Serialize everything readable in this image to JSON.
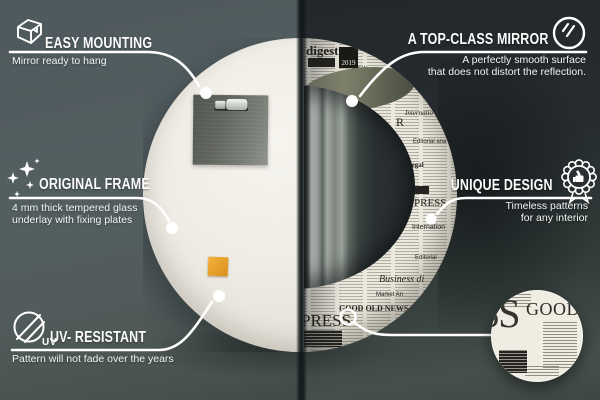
{
  "callouts": {
    "easy_mounting": {
      "title": "EASY MOUNTING",
      "subtitle": "Mirror ready to hang",
      "icon": "box-icon"
    },
    "original_frame": {
      "title": "ORIGINAL FRAME",
      "subtitle_line1": "4 mm thick tempered glass",
      "subtitle_line2": "underlay with fixing plates",
      "icon": "sparkles-icon"
    },
    "uv_resistant": {
      "title": "UV- RESISTANT",
      "subtitle": "Pattern will not fade over the years",
      "icon": "uv-circle-icon",
      "icon_text": "UV"
    },
    "top_class_mirror": {
      "title": "A TOP-CLASS MIRROR",
      "subtitle_line1": "A perfectly smooth surface",
      "subtitle_line2": "that does not distort the reflection.",
      "icon": "mirror-shine-icon"
    },
    "unique_design": {
      "title": "UNIQUE DESIGN",
      "subtitle_line1": "Timeless patterns",
      "subtitle_line2": "for any interior",
      "icon": "award-badge-icon"
    }
  },
  "newspaper": {
    "year": "2019",
    "words": [
      {
        "text": "digest",
        "x": 163,
        "y": 6,
        "size": 13,
        "serif": true,
        "bold": true
      },
      {
        "text": "NEWS",
        "x": 224,
        "y": 39,
        "size": 8,
        "serif": true,
        "bold": true
      },
      {
        "text": "article",
        "x": 209,
        "y": 28,
        "size": 6,
        "italic": true
      },
      {
        "text": "Internatio",
        "x": 262,
        "y": 72,
        "size": 7,
        "serif": true,
        "italic": true
      },
      {
        "text": "R",
        "x": 253,
        "y": 78,
        "size": 12,
        "serif": true
      },
      {
        "text": "Editorial ana",
        "x": 270,
        "y": 101,
        "size": 6
      },
      {
        "text": "Legal",
        "x": 264,
        "y": 124,
        "size": 7,
        "serif": true,
        "bold": true
      },
      {
        "text": "PRESS",
        "x": 271,
        "y": 160,
        "size": 11,
        "serif": true
      },
      {
        "text": "Internation",
        "x": 269,
        "y": 186,
        "size": 7
      },
      {
        "text": "Editorial",
        "x": 272,
        "y": 217,
        "size": 6
      },
      {
        "text": "Business di",
        "x": 236,
        "y": 237,
        "size": 10,
        "serif": true,
        "italic": true
      },
      {
        "text": "Market An",
        "x": 233,
        "y": 254,
        "size": 6
      },
      {
        "text": "GOOD OLD NEWS",
        "x": 196,
        "y": 267,
        "size": 8,
        "serif": true,
        "bold": true
      },
      {
        "text": "PRESS",
        "x": 158,
        "y": 274,
        "size": 17,
        "serif": true
      }
    ]
  },
  "detail_circle": {
    "word_large": "GOOD",
    "word_cut": "SS"
  },
  "colors": {
    "accent_orange": "#e2a12b",
    "paper": "#ebe8dd",
    "left_bg": "#535e60",
    "right_bg": "#262c2f",
    "line": "#ffffff"
  }
}
